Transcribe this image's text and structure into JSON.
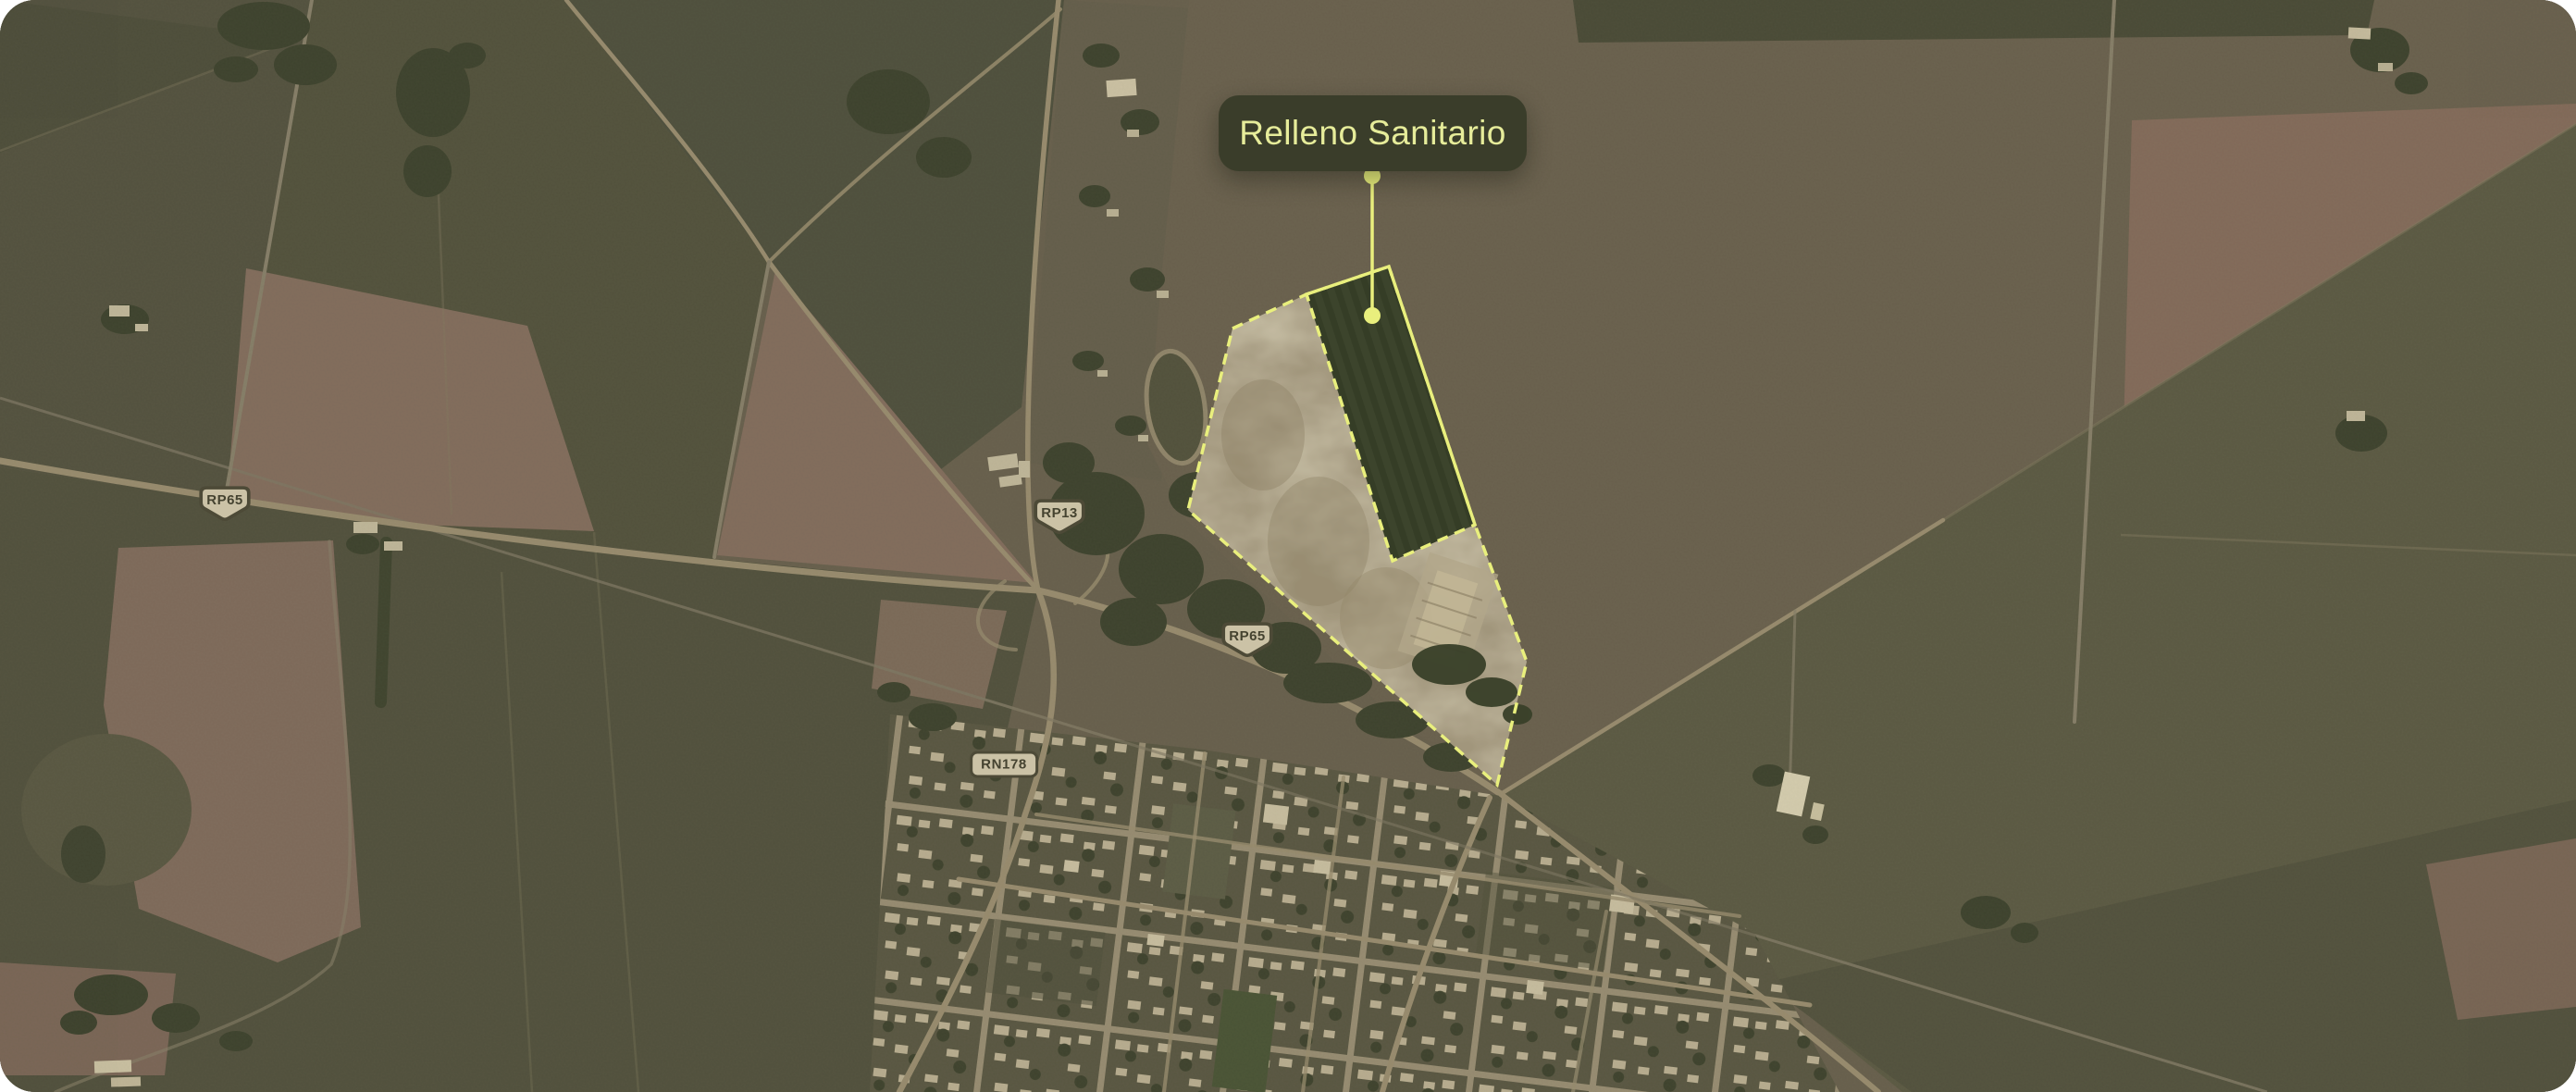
{
  "theme": {
    "page_bg": "#ffffff",
    "map_base": "#6d6452",
    "accent_yellow": "#e9ef7d",
    "tooltip_bg": "#3a3d2a",
    "tooltip_text": "#e6ec9a",
    "shield_bg": "#cbc2a6",
    "shield_border": "#4d4a37",
    "shield_text": "#454330",
    "road_color": "#a39577",
    "road_minor": "#8f8670",
    "railway_color": "#857d69"
  },
  "annotation": {
    "tooltip_label": "Relleno Sanitario"
  },
  "road_labels": {
    "rp65_west": "RP65",
    "rp13": "RP13",
    "rp65_east": "RP65",
    "rn178": "RN178"
  }
}
